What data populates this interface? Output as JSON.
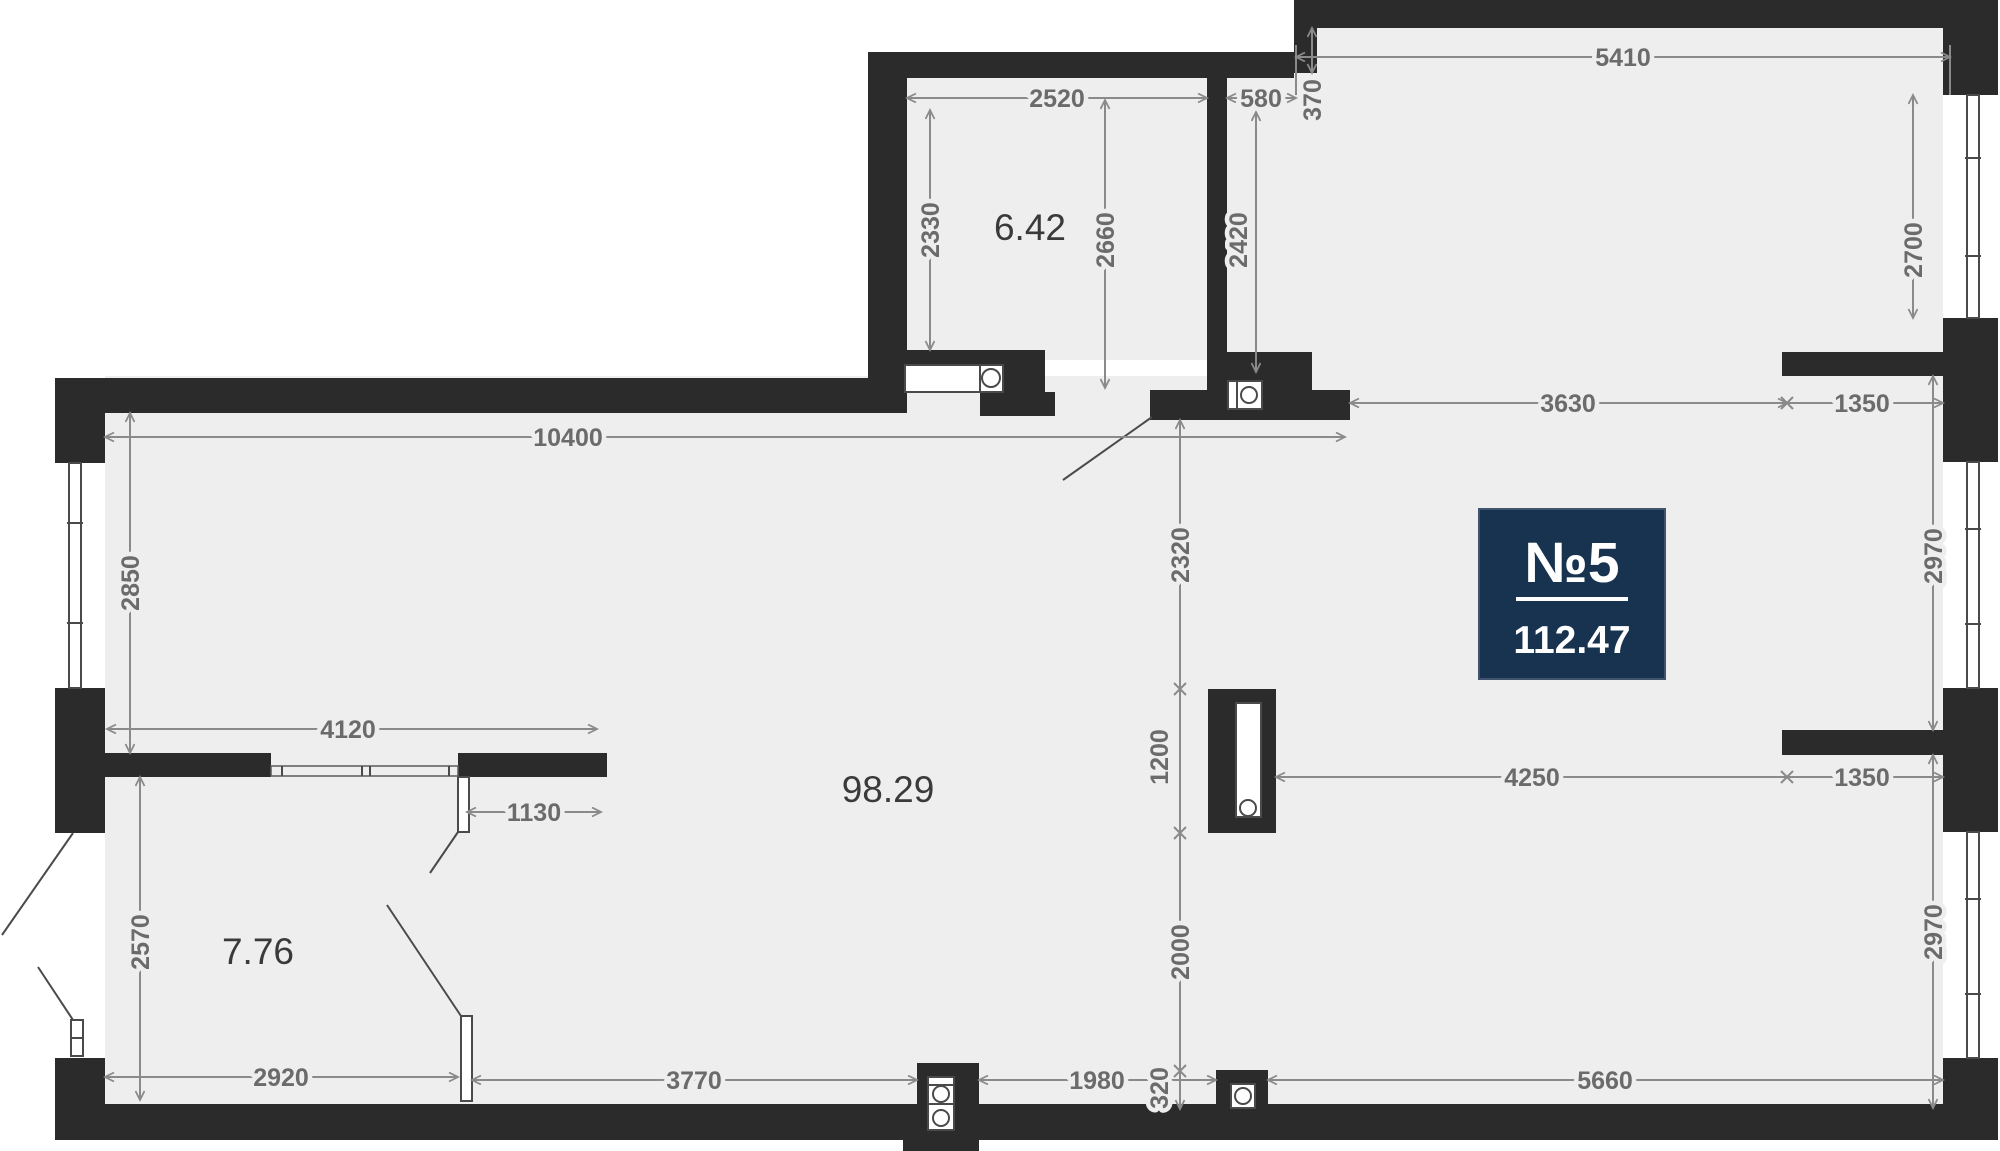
{
  "title": "apartment-floor-plan",
  "colors": {
    "wall": "#2b2b2c",
    "floor": "#eeeeef",
    "window_frame": "#4a4a4a",
    "dim_line": "#8a8a8a",
    "dim_text": "#6b6b6b",
    "room_text": "#3a3a3a",
    "badge_bg": "#17334f",
    "badge_text": "#ffffff",
    "background": "#ffffff"
  },
  "badge": {
    "number": "№5",
    "area": "112.47"
  },
  "rooms": {
    "storage_area": "6.42",
    "main_area": "98.29",
    "wardrobe_area": "7.76"
  },
  "dims": {
    "storage_width": "2520",
    "storage_depth_left": "2330",
    "storage_depth_right": "2660",
    "niche_width": "580",
    "niche_offset": "370",
    "hall_depth": "2420",
    "living_width": "5410",
    "living_window": "2700",
    "living_opening": "3630",
    "pier_top": "1350",
    "window_mid_right": "2970",
    "pier_bottom": "1350",
    "window_bottom_right": "2970",
    "main_width": "10400",
    "main_window_left": "2850",
    "to_column": "2320",
    "column_len": "1200",
    "below_column": "2000",
    "shaft_gap": "320",
    "column_to_pier": "4250",
    "partition_span": "4120",
    "door_width": "1130",
    "wardrobe_depth": "2570",
    "wardrobe_width": "2920",
    "bottom_left_span": "3770",
    "bottom_mid_span": "1980",
    "bottom_right_span": "5660"
  }
}
